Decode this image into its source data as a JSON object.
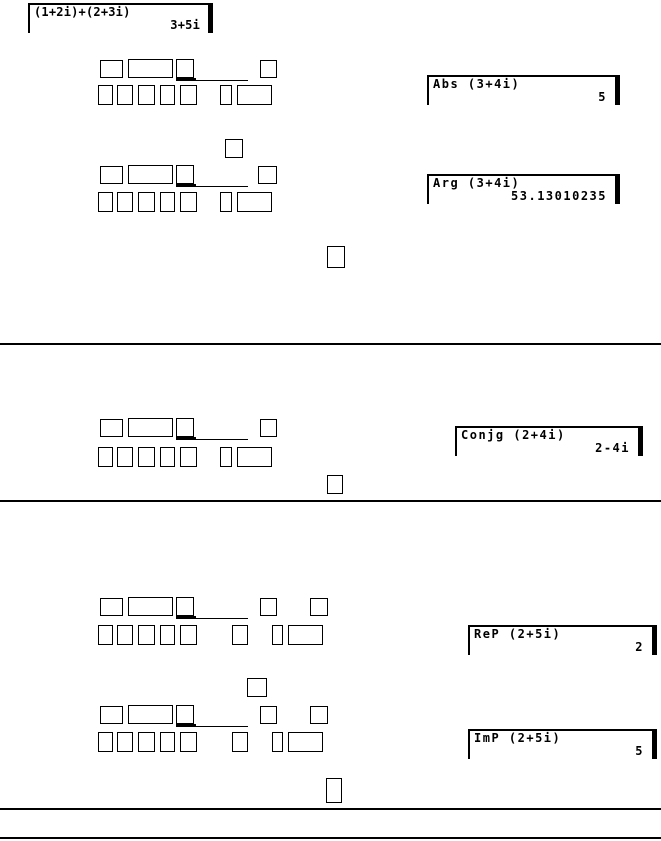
{
  "page": {
    "background_color": "#ffffff",
    "ink_color": "#000000"
  },
  "displays": [
    {
      "expression": "(1+2i)+(2+3i)",
      "result": "3+5i"
    },
    {
      "expression": "Abs (3+4i)",
      "result": "5"
    },
    {
      "expression": "Arg (3+4i)",
      "result": "53.13010235"
    },
    {
      "expression": "Conjg (2+4i)",
      "result": "2-4i"
    },
    {
      "expression": "ReP (2+5i)",
      "result": "2"
    },
    {
      "expression": "ImP (2+5i)",
      "result": "5"
    }
  ],
  "key_graphics": {
    "boxes": [
      [
        100,
        60,
        23,
        18
      ],
      [
        128,
        59,
        45,
        19
      ],
      [
        176,
        59,
        18,
        19
      ],
      [
        260,
        60,
        17,
        18
      ],
      [
        98,
        85,
        15,
        20
      ],
      [
        117,
        85,
        16,
        20
      ],
      [
        138,
        85,
        17,
        20
      ],
      [
        160,
        85,
        15,
        20
      ],
      [
        180,
        85,
        17,
        20
      ],
      [
        220,
        85,
        12,
        20
      ],
      [
        237,
        85,
        35,
        20
      ],
      [
        225,
        139,
        18,
        19
      ],
      [
        100,
        166,
        23,
        18
      ],
      [
        128,
        165,
        45,
        19
      ],
      [
        176,
        165,
        18,
        19
      ],
      [
        258,
        166,
        19,
        18
      ],
      [
        98,
        192,
        15,
        20
      ],
      [
        117,
        192,
        16,
        20
      ],
      [
        138,
        192,
        17,
        20
      ],
      [
        160,
        192,
        15,
        20
      ],
      [
        180,
        192,
        17,
        20
      ],
      [
        220,
        192,
        12,
        20
      ],
      [
        237,
        192,
        35,
        20
      ],
      [
        327,
        246,
        18,
        22
      ],
      [
        100,
        419,
        23,
        18
      ],
      [
        128,
        418,
        45,
        19
      ],
      [
        176,
        418,
        18,
        19
      ],
      [
        260,
        419,
        17,
        18
      ],
      [
        98,
        447,
        15,
        20
      ],
      [
        117,
        447,
        16,
        20
      ],
      [
        138,
        447,
        17,
        20
      ],
      [
        160,
        447,
        15,
        20
      ],
      [
        180,
        447,
        17,
        20
      ],
      [
        220,
        447,
        12,
        20
      ],
      [
        237,
        447,
        35,
        20
      ],
      [
        327,
        475,
        16,
        19
      ],
      [
        100,
        598,
        23,
        18
      ],
      [
        128,
        597,
        45,
        19
      ],
      [
        176,
        597,
        18,
        19
      ],
      [
        260,
        598,
        17,
        18
      ],
      [
        310,
        598,
        18,
        18
      ],
      [
        98,
        625,
        15,
        20
      ],
      [
        117,
        625,
        16,
        20
      ],
      [
        138,
        625,
        17,
        20
      ],
      [
        160,
        625,
        15,
        20
      ],
      [
        180,
        625,
        17,
        20
      ],
      [
        232,
        625,
        16,
        20
      ],
      [
        272,
        625,
        11,
        20
      ],
      [
        288,
        625,
        35,
        20
      ],
      [
        247,
        678,
        20,
        19
      ],
      [
        100,
        706,
        23,
        18
      ],
      [
        128,
        705,
        45,
        19
      ],
      [
        176,
        705,
        18,
        19
      ],
      [
        260,
        706,
        17,
        18
      ],
      [
        310,
        706,
        18,
        18
      ],
      [
        98,
        732,
        15,
        20
      ],
      [
        117,
        732,
        16,
        20
      ],
      [
        138,
        732,
        17,
        20
      ],
      [
        160,
        732,
        15,
        20
      ],
      [
        180,
        732,
        17,
        20
      ],
      [
        232,
        732,
        16,
        20
      ],
      [
        272,
        732,
        11,
        20
      ],
      [
        288,
        732,
        35,
        20
      ],
      [
        326,
        778,
        16,
        25
      ]
    ],
    "underlines": [
      [
        176,
        78,
        20,
        3
      ],
      [
        194,
        80,
        54,
        1
      ],
      [
        176,
        184,
        20,
        3
      ],
      [
        194,
        186,
        54,
        1
      ],
      [
        176,
        437,
        20,
        3
      ],
      [
        194,
        439,
        54,
        1
      ],
      [
        176,
        616,
        20,
        3
      ],
      [
        194,
        618,
        54,
        1
      ],
      [
        176,
        724,
        20,
        3
      ],
      [
        194,
        726,
        54,
        1
      ]
    ]
  },
  "dividers": [
    [
      0,
      343,
      661,
      2
    ],
    [
      0,
      500,
      661,
      2
    ],
    [
      0,
      808,
      661,
      2
    ],
    [
      0,
      837,
      661,
      2
    ]
  ]
}
